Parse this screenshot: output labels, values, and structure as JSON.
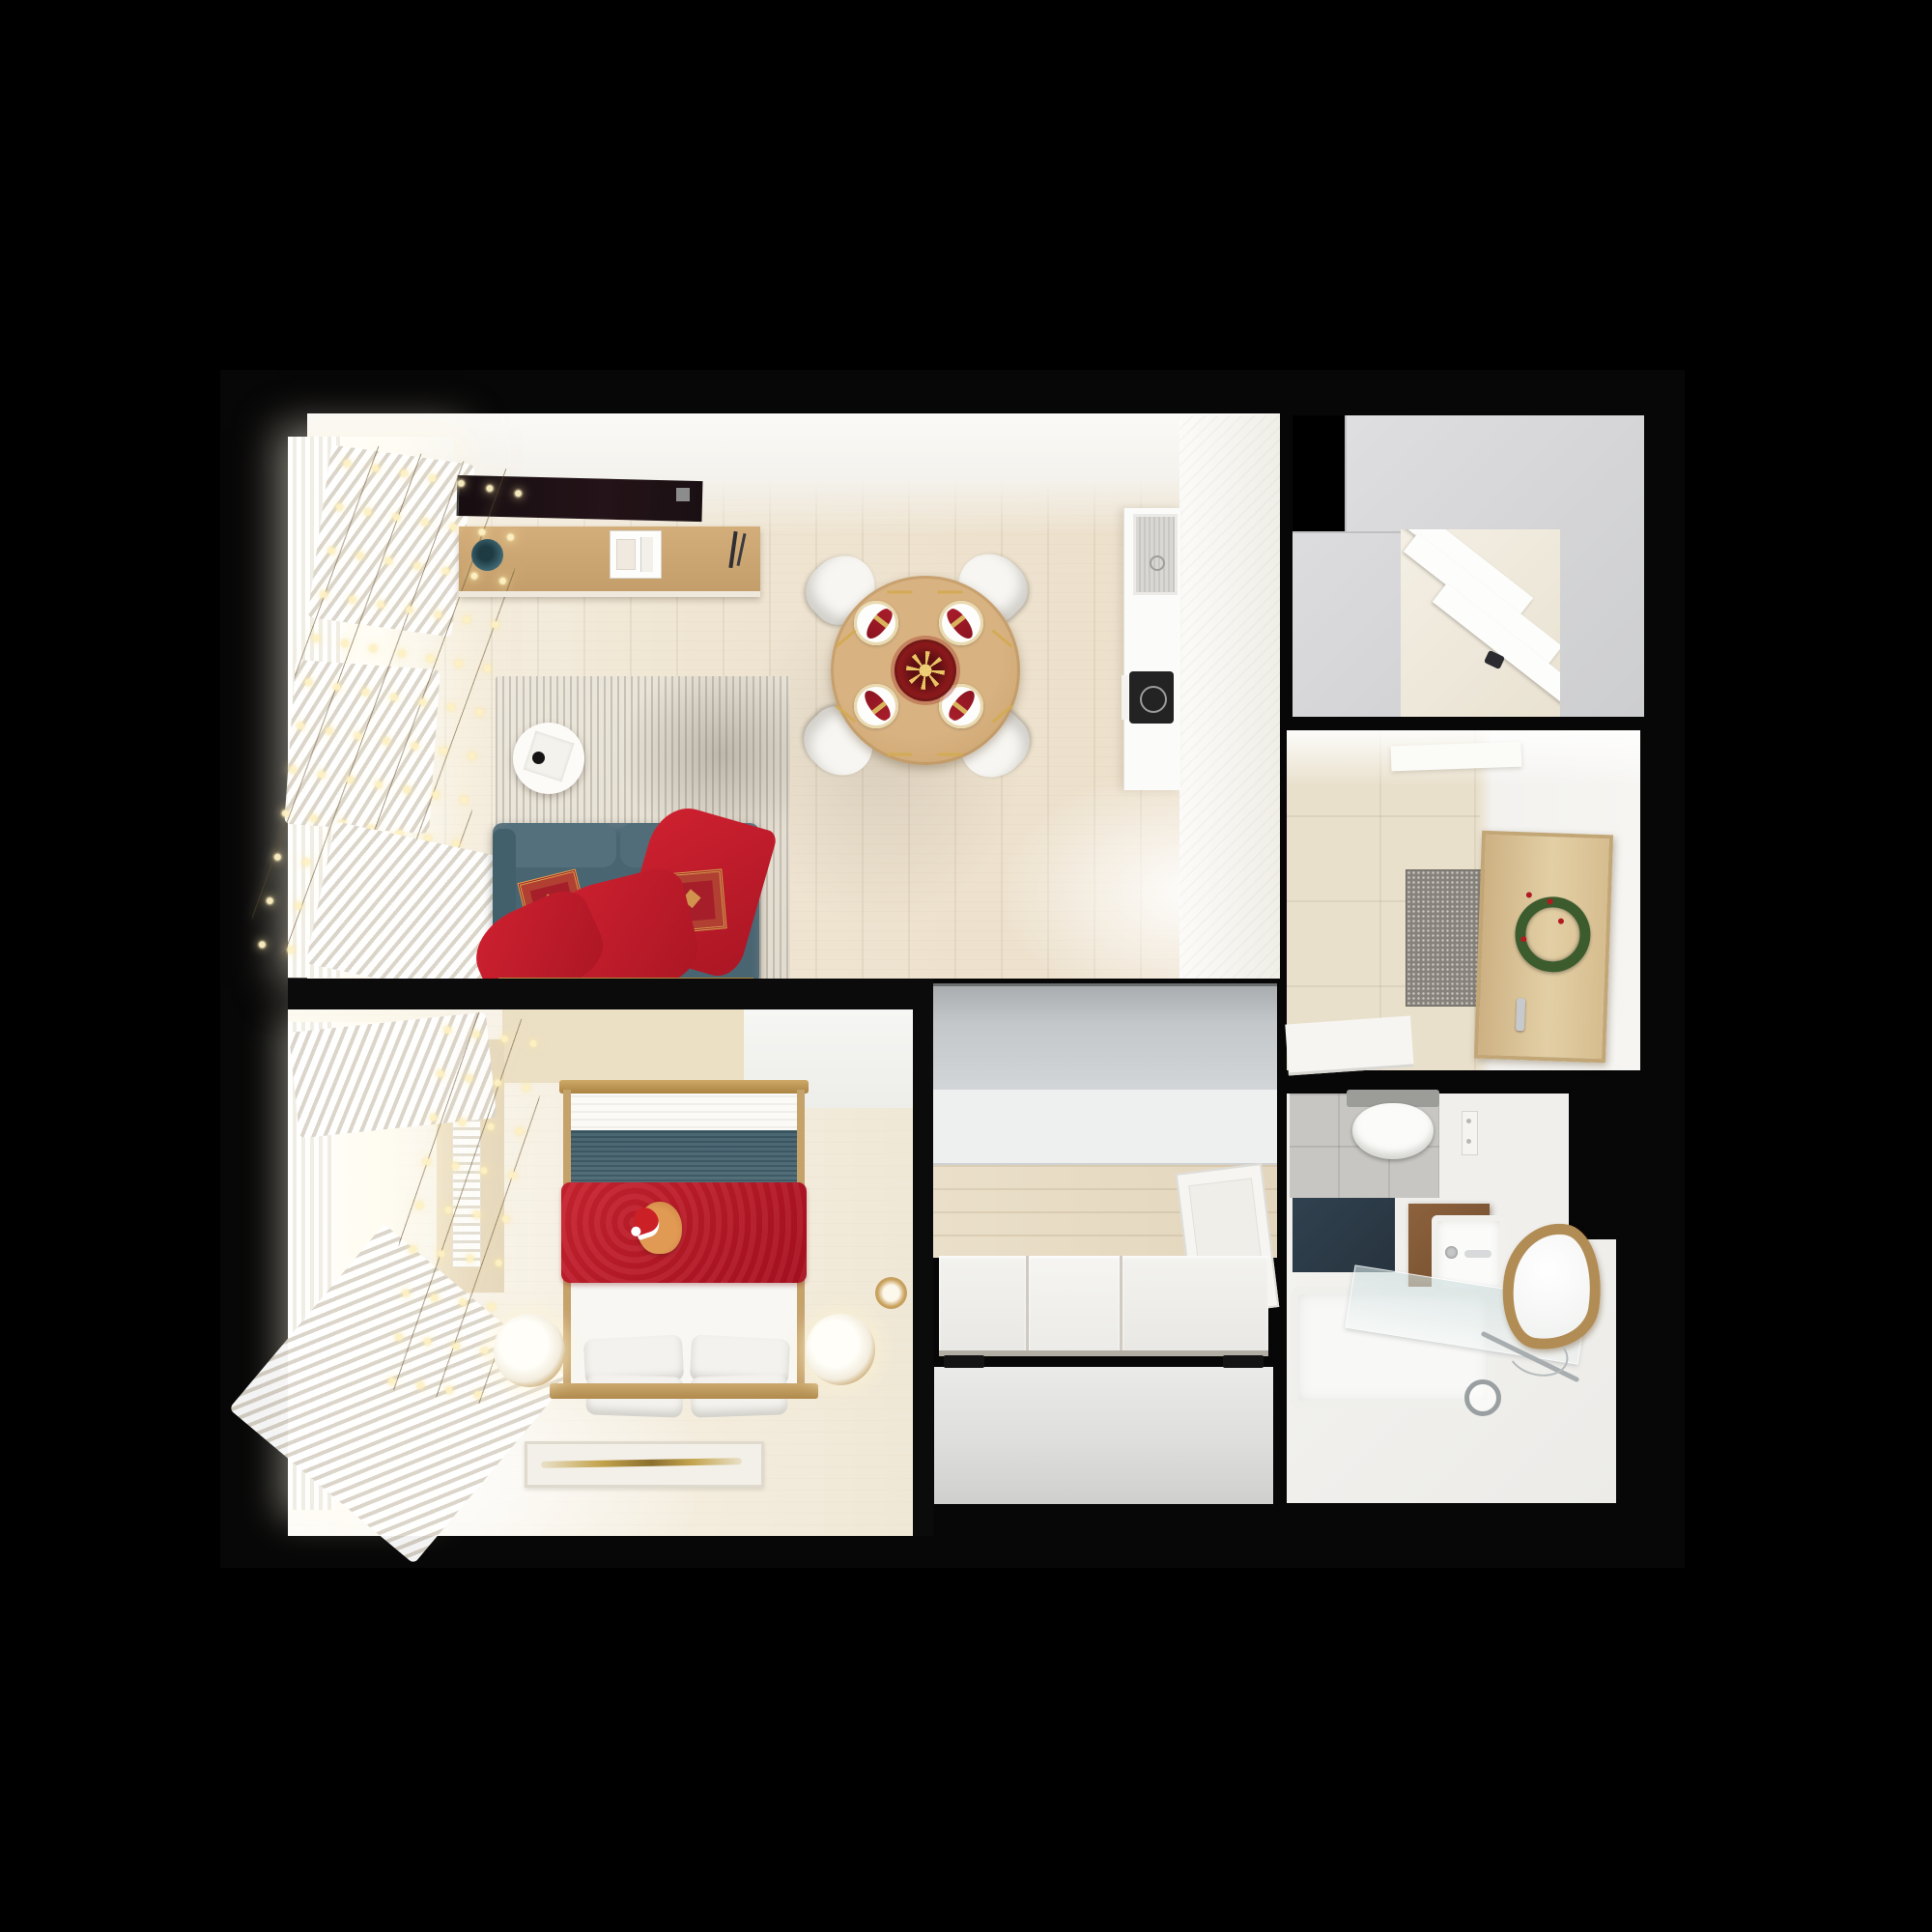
{
  "scene": {
    "type": "top-down 3D render of a one-bedroom apartment floor plan, christmas decorated",
    "background_color": "#000000",
    "no_visible_text": true
  },
  "palette": {
    "background": "#000000",
    "wall": "#0b0b0b",
    "wood_floor_light": "#efe5d2",
    "wood_furniture": "#c9a36e",
    "white_surface": "#f4f3f0",
    "gray_cabinet": "#c6c9cb",
    "sofa_teal": "#4a6572",
    "bedding_teal": "#42606c",
    "christmas_red": "#c2202e",
    "gold_accent": "#d9a94f",
    "fairy_light_glow": "#fdf1c3",
    "wreath_green": "#3c5c2e",
    "vanity_wood": "#7d5634",
    "bath_mat_navy": "#2c3b48",
    "mirror_brass": "#b28c55"
  },
  "rooms": {
    "living_room": {
      "label": "Living room with dining area and kitchen",
      "items": [
        "wall-mounted TV",
        "media console with teal vase and storage box",
        "striped area rug",
        "round white coffee table",
        "teal sofa with red ornate pillows and red throw blanket",
        "round wooden dining table set for four with red napkins and gold cutlery",
        "red and gold centerpiece with gold star",
        "four white chairs",
        "kitchen counter with sink and induction hob",
        "window with sheer curtains and fairy lights"
      ]
    },
    "bedroom": {
      "label": "Bedroom",
      "items": [
        "double bed with white, teal and red layered bedding",
        "ginger cat in santa hat on bed",
        "four white pillows",
        "two cylindrical bedside lamps",
        "candle",
        "white rug with gold line",
        "radiator",
        "window with curtains and fairy lights"
      ]
    },
    "hallway": {
      "label": "Hallway",
      "items": [
        "gray cabinet run",
        "white cabinet band",
        "wood floor",
        "open white interior door",
        "sliding-door wardrobe with black handles"
      ]
    },
    "closet_room": {
      "label": "Walk-in closet",
      "items": [
        "gray cabinet tops",
        "open shelving niche"
      ]
    },
    "entry_hall": {
      "label": "Entry hall",
      "items": [
        "beige tile floor",
        "speckled gray doormat",
        "wooden front door with green wreath and silver handle",
        "open white door leaf"
      ]
    },
    "bathroom": {
      "label": "Bathroom",
      "items": [
        "gray tile floor",
        "wall-hung toilet",
        "navy bath mat",
        "wood vanity with square white sink",
        "brass organic-shaped mirror",
        "glass shower panel",
        "bathtub",
        "chrome shower fixture",
        "wall outlet"
      ]
    }
  }
}
